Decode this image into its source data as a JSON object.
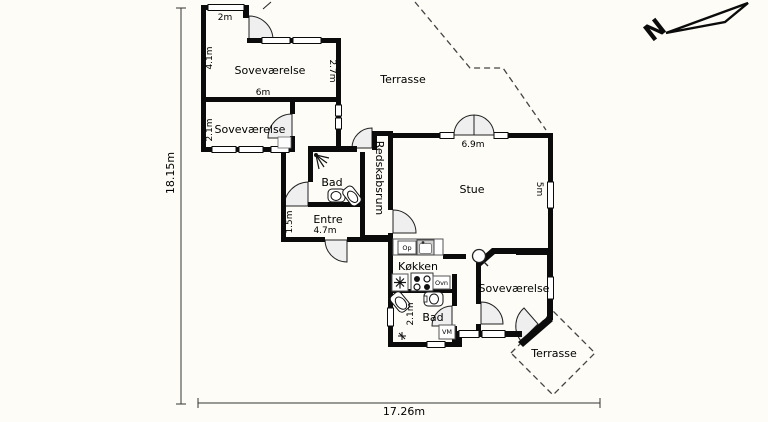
{
  "colors": {
    "background": "#fdfcf6",
    "walls": "#0b0b0b",
    "door_fill": "#efefef"
  },
  "plan": {
    "rooms": {
      "bedroom_top": "Soveværelse",
      "bedroom_mid": "Soveværelse",
      "bedroom_bottom": "Soveværelse",
      "living_room": "Stue",
      "kitchen": "Køkken",
      "bath_main": "Bad",
      "bath_small": "Bad",
      "entry": "Entre",
      "utility": "Redskabsrum",
      "terrace_upper": "Terrasse",
      "terrace_lower": "Terrasse"
    },
    "dimensions": {
      "total_height": "18.15m",
      "total_width": "17.26m",
      "alcove": "2m",
      "bedroom_top_left": "4.1m",
      "bedroom_top_right": "2.7m",
      "bedroom_top_bottom": "6m",
      "bedroom_mid_left": "2.1m",
      "living_top": "6.9m",
      "living_right": "5m",
      "entry_left": "1.5m",
      "entry_bottom": "4.7m",
      "bath_small_left": "2.1m"
    },
    "appliances": {
      "dishwasher": "Op",
      "oven": "Ovn",
      "washing_machine": "VM"
    },
    "compass": {
      "north": "N"
    }
  }
}
